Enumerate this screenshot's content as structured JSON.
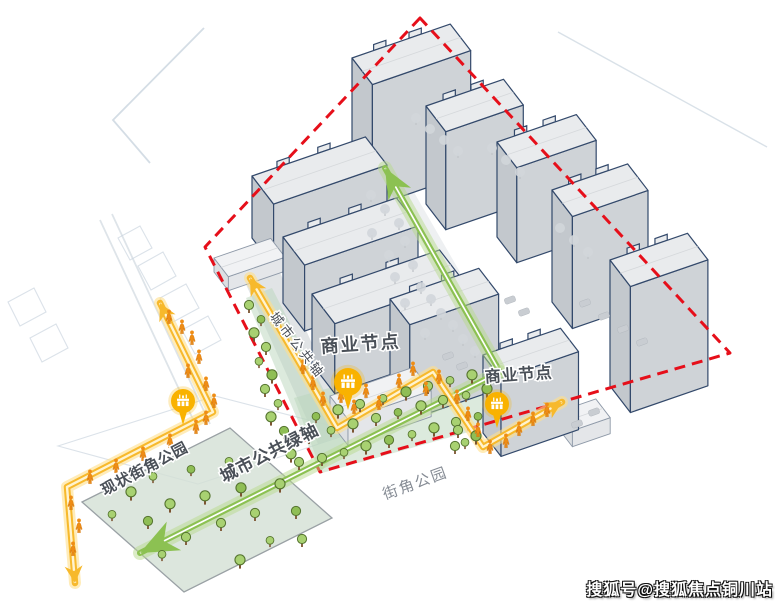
{
  "title": "urban-design-analysis-diagram",
  "watermark": {
    "text": "搜狐号@搜狐焦点铜川站",
    "color": "#ffffff",
    "outline": "#111111"
  },
  "colors": {
    "boundary_red": "#e60f1a",
    "route_yellow": "#f7b92c",
    "route_yellow_glow": "#ffe08a",
    "axis_green": "#8cc152",
    "axis_green_glow": "#b7d98e",
    "building_outline": "#33496b",
    "building_roof": "#e9ebed",
    "building_wall": "#cfd3d7",
    "building_wall_end": "#c3c8cd",
    "teal_band": "#b9d6bc",
    "park_fill": "#d3e0d5",
    "pin_yellow": "#f9b200",
    "pedestrian_orange": "#ef8d15",
    "tree_green": "#a8d171",
    "tree_gray": "#d2d6da",
    "label_dark": "#4a5058"
  },
  "labels": [
    {
      "id": "label-commercial-node-1",
      "text": "商业节点",
      "x": 361,
      "y": 350,
      "rotate": -4,
      "size": 18,
      "weight": "bold",
      "color": "#4a5058",
      "spacing": 2
    },
    {
      "id": "label-commercial-node-2",
      "text": "商业节点",
      "x": 519,
      "y": 380,
      "rotate": -4,
      "size": 16,
      "weight": "bold",
      "color": "#4a5058",
      "spacing": 1
    },
    {
      "id": "label-urban-public-axis",
      "text": "城市公共轴",
      "x": 294,
      "y": 348,
      "rotate": 52,
      "size": 13,
      "weight": "normal",
      "color": "#474d56",
      "spacing": 3
    },
    {
      "id": "label-urban-public-green-axis",
      "text": "城市公共绿轴",
      "x": 272,
      "y": 458,
      "rotate": -27,
      "size": 17,
      "weight": "bold",
      "color": "#4a5058",
      "spacing": 1
    },
    {
      "id": "label-existing-corner-park",
      "text": "现状街角公园",
      "x": 147,
      "y": 473,
      "rotate": -28,
      "size": 15,
      "weight": "bold",
      "color": "#4a5058",
      "spacing": 1
    },
    {
      "id": "label-corner-park",
      "text": "街角公园",
      "x": 417,
      "y": 488,
      "rotate": -20,
      "size": 15,
      "weight": "normal",
      "color": "#858b94",
      "spacing": 2
    }
  ],
  "boundary": {
    "points": [
      [
        420,
        18
      ],
      [
        205,
        247
      ],
      [
        320,
        472
      ],
      [
        730,
        353
      ]
    ]
  },
  "green_axes": [
    {
      "name": "green-axis-north-arrow",
      "points": [
        [
          500,
          372
        ],
        [
          385,
          168
        ]
      ],
      "arrow_len": 30,
      "arrow_w": 13
    },
    {
      "name": "green-axis-southwest-arrow",
      "points": [
        [
          500,
          372
        ],
        [
          140,
          553
        ]
      ],
      "arrow_len": 38,
      "arrow_w": 16
    }
  ],
  "yellow_routes": [
    {
      "name": "west-pedestrian-route",
      "points": [
        [
          160,
          303
        ],
        [
          213,
          412
        ],
        [
          67,
          487
        ],
        [
          75,
          583
        ]
      ]
    },
    {
      "name": "central-commercial-route",
      "points": [
        [
          250,
          278
        ],
        [
          337,
          428
        ],
        [
          433,
          372
        ],
        [
          483,
          447
        ],
        [
          562,
          402
        ]
      ]
    }
  ],
  "pins": [
    {
      "name": "commercial-node-pin-1",
      "x": 348,
      "y": 382,
      "r": 14
    },
    {
      "name": "commercial-node-pin-2",
      "x": 497,
      "y": 404,
      "r": 12
    },
    {
      "name": "park-node-pin",
      "x": 183,
      "y": 401,
      "r": 12
    }
  ],
  "buildings": [
    {
      "x": 352,
      "y": 180,
      "len": 104,
      "dep": 34,
      "h": 122
    },
    {
      "x": 426,
      "y": 204,
      "len": 82,
      "dep": 33,
      "h": 98
    },
    {
      "x": 497,
      "y": 237,
      "len": 84,
      "dep": 33,
      "h": 95
    },
    {
      "x": 252,
      "y": 238,
      "len": 120,
      "dep": 36,
      "h": 62
    },
    {
      "x": 552,
      "y": 302,
      "len": 80,
      "dep": 34,
      "h": 112
    },
    {
      "x": 283,
      "y": 303,
      "len": 120,
      "dep": 36,
      "h": 66
    },
    {
      "x": 312,
      "y": 364,
      "len": 135,
      "dep": 38,
      "h": 70
    },
    {
      "x": 610,
      "y": 386,
      "len": 82,
      "dep": 34,
      "h": 126
    },
    {
      "x": 390,
      "y": 394,
      "len": 94,
      "dep": 33,
      "h": 95
    },
    {
      "x": 330,
      "y": 422,
      "len": 88,
      "dep": 30,
      "h": 26,
      "light": true
    },
    {
      "x": 483,
      "y": 433,
      "len": 82,
      "dep": 30,
      "h": 78
    },
    {
      "x": 558,
      "y": 428,
      "len": 40,
      "dep": 24,
      "h": 16,
      "light": true
    },
    {
      "x": 214,
      "y": 272,
      "len": 60,
      "dep": 24,
      "h": 14,
      "light": true
    }
  ],
  "strips": {
    "left_strip": [
      [
        246,
        298
      ],
      [
        272,
        288
      ],
      [
        348,
        438
      ],
      [
        320,
        473
      ]
    ],
    "bottom_band": [
      [
        294,
        398
      ],
      [
        470,
        348
      ],
      [
        508,
        421
      ],
      [
        322,
        473
      ]
    ],
    "park": [
      [
        82,
        502
      ],
      [
        230,
        428
      ],
      [
        332,
        518
      ],
      [
        184,
        592
      ]
    ],
    "sidewalk": [
      [
        234,
        258
      ],
      [
        268,
        246
      ],
      [
        352,
        432
      ],
      [
        318,
        444
      ]
    ],
    "road_axis": [
      [
        400,
        168
      ],
      [
        513,
        364
      ],
      [
        497,
        372
      ],
      [
        384,
        176
      ]
    ],
    "road_band": [
      [
        333,
        419
      ],
      [
        557,
        362
      ],
      [
        560,
        374
      ],
      [
        336,
        431
      ]
    ]
  },
  "background_lines": {
    "polylines": [
      [
        [
          204,
          28
        ],
        [
          113,
          120
        ],
        [
          150,
          163
        ]
      ],
      [
        [
          558,
          32
        ],
        [
          767,
          147
        ]
      ],
      [
        [
          100,
          220
        ],
        [
          198,
          430
        ]
      ],
      [
        [
          112,
          214
        ],
        [
          210,
          424
        ]
      ]
    ],
    "quads": [
      [
        [
          118,
          238
        ],
        [
          140,
          226
        ],
        [
          152,
          248
        ],
        [
          130,
          260
        ]
      ],
      [
        [
          138,
          266
        ],
        [
          163,
          252
        ],
        [
          176,
          276
        ],
        [
          151,
          290
        ]
      ],
      [
        [
          160,
          298
        ],
        [
          186,
          284
        ],
        [
          199,
          308
        ],
        [
          173,
          322
        ]
      ],
      [
        [
          182,
          330
        ],
        [
          208,
          316
        ],
        [
          221,
          340
        ],
        [
          195,
          354
        ]
      ],
      [
        [
          8,
          302
        ],
        [
          34,
          288
        ],
        [
          46,
          312
        ],
        [
          20,
          326
        ]
      ],
      [
        [
          30,
          338
        ],
        [
          56,
          324
        ],
        [
          68,
          348
        ],
        [
          42,
          362
        ]
      ],
      [
        [
          58,
          446
        ],
        [
          215,
          396
        ],
        [
          355,
          432
        ],
        [
          198,
          484
        ]
      ]
    ]
  },
  "trees_green": [
    [
      249,
      307
    ],
    [
      261,
      321
    ],
    [
      254,
      335
    ],
    [
      266,
      349
    ],
    [
      259,
      363
    ],
    [
      272,
      377
    ],
    [
      265,
      391
    ],
    [
      278,
      405
    ],
    [
      271,
      419
    ],
    [
      284,
      433
    ],
    [
      278,
      447
    ],
    [
      291,
      456
    ],
    [
      299,
      464
    ],
    [
      316,
      418
    ],
    [
      338,
      412
    ],
    [
      360,
      406
    ],
    [
      383,
      400
    ],
    [
      406,
      394
    ],
    [
      428,
      388
    ],
    [
      450,
      382
    ],
    [
      472,
      377
    ],
    [
      309,
      438
    ],
    [
      331,
      432
    ],
    [
      353,
      426
    ],
    [
      376,
      420
    ],
    [
      398,
      414
    ],
    [
      421,
      408
    ],
    [
      443,
      402
    ],
    [
      466,
      397
    ],
    [
      487,
      391
    ],
    [
      322,
      460
    ],
    [
      344,
      454
    ],
    [
      366,
      448
    ],
    [
      389,
      442
    ],
    [
      412,
      436
    ],
    [
      434,
      430
    ],
    [
      456,
      424
    ],
    [
      478,
      418
    ],
    [
      499,
      412
    ],
    [
      458,
      432
    ],
    [
      465,
      444
    ],
    [
      476,
      438
    ],
    [
      455,
      448
    ],
    [
      112,
      516
    ],
    [
      131,
      494
    ],
    [
      148,
      523
    ],
    [
      153,
      478
    ],
    [
      170,
      506
    ],
    [
      186,
      539
    ],
    [
      191,
      471
    ],
    [
      205,
      498
    ],
    [
      221,
      525
    ],
    [
      229,
      463
    ],
    [
      241,
      490
    ],
    [
      255,
      515
    ],
    [
      270,
      542
    ],
    [
      280,
      486
    ],
    [
      296,
      513
    ],
    [
      162,
      556
    ],
    [
      240,
      562
    ],
    [
      302,
      541
    ]
  ],
  "trees_gray": [
    [
      371,
      197
    ],
    [
      385,
      211
    ],
    [
      399,
      225
    ],
    [
      372,
      235
    ],
    [
      405,
      243
    ],
    [
      389,
      257
    ],
    [
      413,
      267
    ],
    [
      395,
      279
    ],
    [
      421,
      289
    ],
    [
      431,
      301
    ],
    [
      405,
      305
    ],
    [
      441,
      315
    ],
    [
      453,
      327
    ],
    [
      425,
      335
    ],
    [
      463,
      341
    ],
    [
      475,
      353
    ],
    [
      416,
      120
    ],
    [
      430,
      131
    ],
    [
      444,
      142
    ],
    [
      458,
      153
    ],
    [
      492,
      150
    ],
    [
      506,
      162
    ],
    [
      520,
      174
    ],
    [
      560,
      230
    ],
    [
      574,
      242
    ],
    [
      588,
      254
    ]
  ],
  "cars": [
    [
      585,
      303
    ],
    [
      604,
      316
    ],
    [
      623,
      329
    ],
    [
      642,
      342
    ],
    [
      577,
      424
    ],
    [
      594,
      412
    ],
    [
      448,
      356
    ],
    [
      462,
      366
    ],
    [
      510,
      300
    ],
    [
      524,
      312
    ]
  ],
  "pedestrians": [
    [
      169,
      317
    ],
    [
      182,
      327
    ],
    [
      192,
      338
    ],
    [
      199,
      357
    ],
    [
      188,
      371
    ],
    [
      206,
      384
    ],
    [
      214,
      401
    ],
    [
      206,
      418
    ],
    [
      196,
      427
    ],
    [
      170,
      441
    ],
    [
      143,
      454
    ],
    [
      116,
      466
    ],
    [
      90,
      477
    ],
    [
      71,
      503
    ],
    [
      79,
      526
    ],
    [
      73,
      549
    ],
    [
      303,
      367
    ],
    [
      313,
      383
    ],
    [
      323,
      399
    ],
    [
      341,
      396
    ],
    [
      354,
      407
    ],
    [
      366,
      391
    ],
    [
      379,
      403
    ],
    [
      399,
      381
    ],
    [
      413,
      369
    ],
    [
      426,
      389
    ],
    [
      439,
      377
    ],
    [
      457,
      397
    ],
    [
      468,
      414
    ],
    [
      478,
      430
    ],
    [
      490,
      447
    ],
    [
      506,
      441
    ],
    [
      519,
      429
    ],
    [
      533,
      419
    ],
    [
      547,
      410
    ]
  ]
}
